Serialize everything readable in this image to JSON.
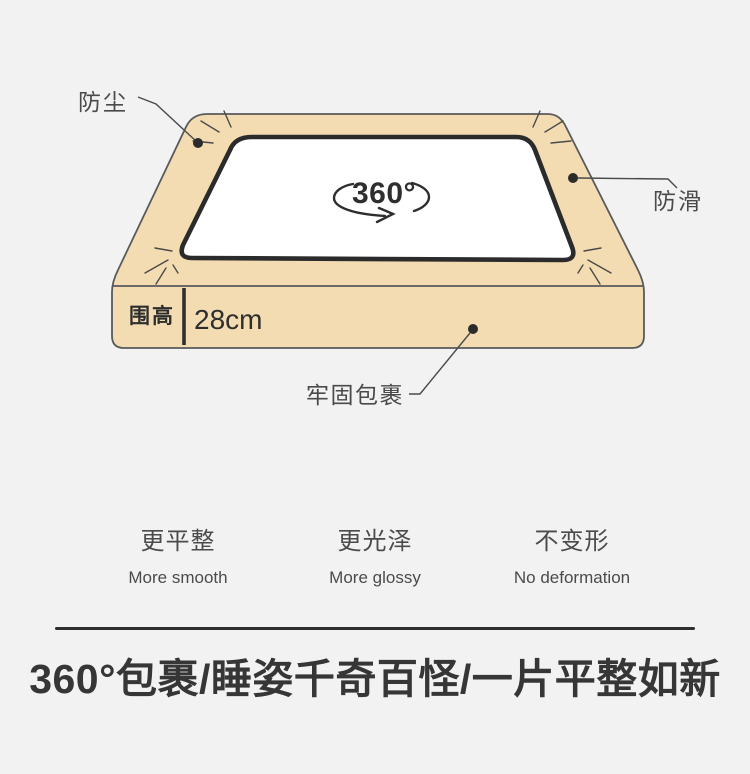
{
  "illustration": {
    "callouts": {
      "dustproof": "防尘",
      "antislip": "防滑",
      "wrap": "牢固包裹"
    },
    "rotation_text": "360°",
    "height": {
      "label": "围高",
      "value": "28cm"
    }
  },
  "features": [
    {
      "zh": "更平整",
      "en": "More smooth"
    },
    {
      "zh": "更光泽",
      "en": "More glossy"
    },
    {
      "zh": "不变形",
      "en": "No deformation"
    }
  ],
  "title": "360°包裹/睡姿千奇百怪/一片平整如新",
  "colors": {
    "background": "#f2f2f2",
    "sheet_side_beige": "#f3dcb1",
    "sheet_top_white": "#ffffff",
    "outline_dark": "#2b2b2b",
    "outline_gray": "#595a5c",
    "text_primary": "#2e2e2e",
    "text_secondary": "#4a4a4a",
    "title_color": "#363636"
  }
}
